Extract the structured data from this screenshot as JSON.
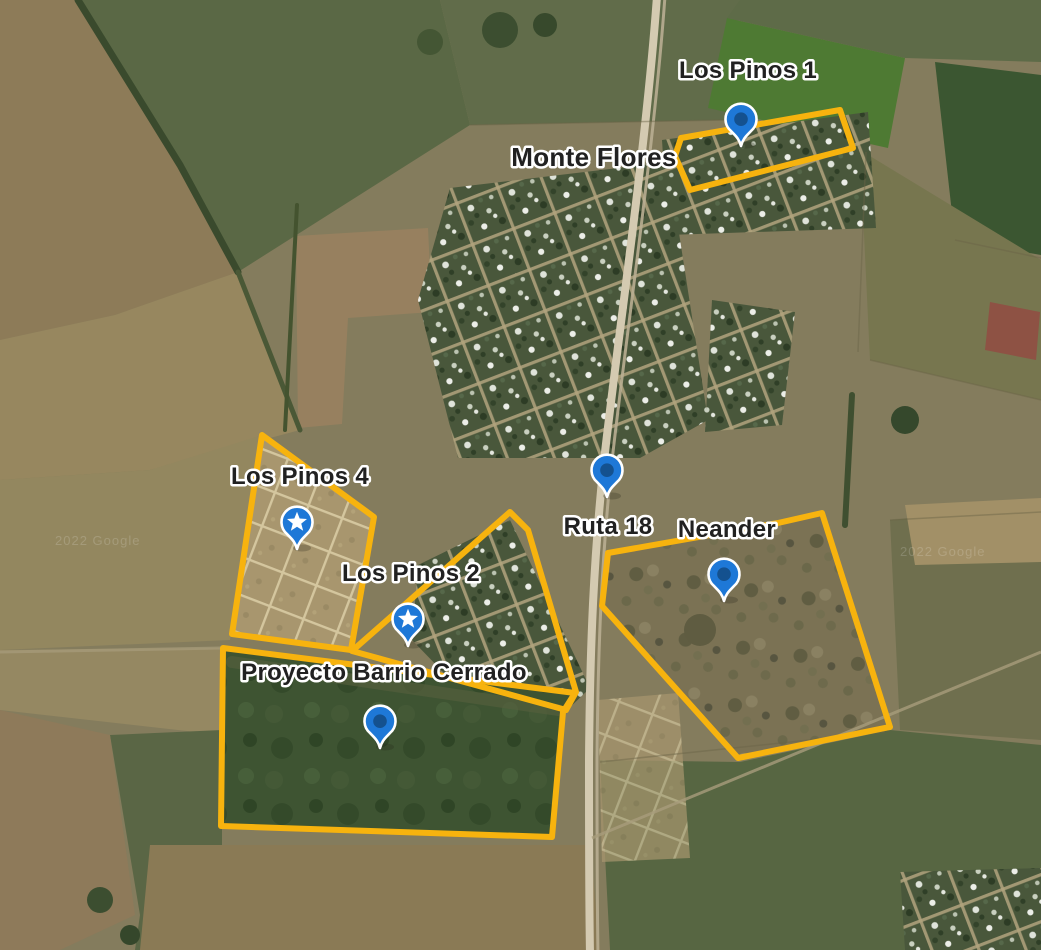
{
  "map": {
    "view": "satellite",
    "attribution_watermark": "2022 Google",
    "labels": {
      "los_pinos_1": "Los Pinos 1",
      "monte_flores": "Monte Flores",
      "los_pinos_4": "Los Pinos 4",
      "ruta_18": "Ruta 18",
      "neander": "Neander",
      "los_pinos_2": "Los Pinos 2",
      "proyecto_barrio_cerrado": "Proyecto Barrio Cerrado"
    },
    "markers": [
      {
        "place": "Los Pinos 1",
        "icon": "pin-dot"
      },
      {
        "place": "Ruta 18",
        "icon": "pin-dot"
      },
      {
        "place": "Neander",
        "icon": "pin-dot"
      },
      {
        "place": "Los Pinos 4",
        "icon": "pin-star"
      },
      {
        "place": "Los Pinos 2",
        "icon": "pin-star"
      },
      {
        "place": "Proyecto Barrio Cerrado",
        "icon": "pin-dot"
      }
    ],
    "outlined_areas": [
      "Los Pinos 1",
      "Los Pinos 4",
      "Los Pinos 2",
      "Neander",
      "Proyecto Barrio Cerrado"
    ],
    "colors": {
      "area_outline": "#F7B30E",
      "pin_fill": "#1E78D7",
      "pin_inner_dot": "#14518F",
      "pin_glyph": "#FFFFFF",
      "label_text": "#212121",
      "label_halo": "#FFFFFF"
    }
  }
}
